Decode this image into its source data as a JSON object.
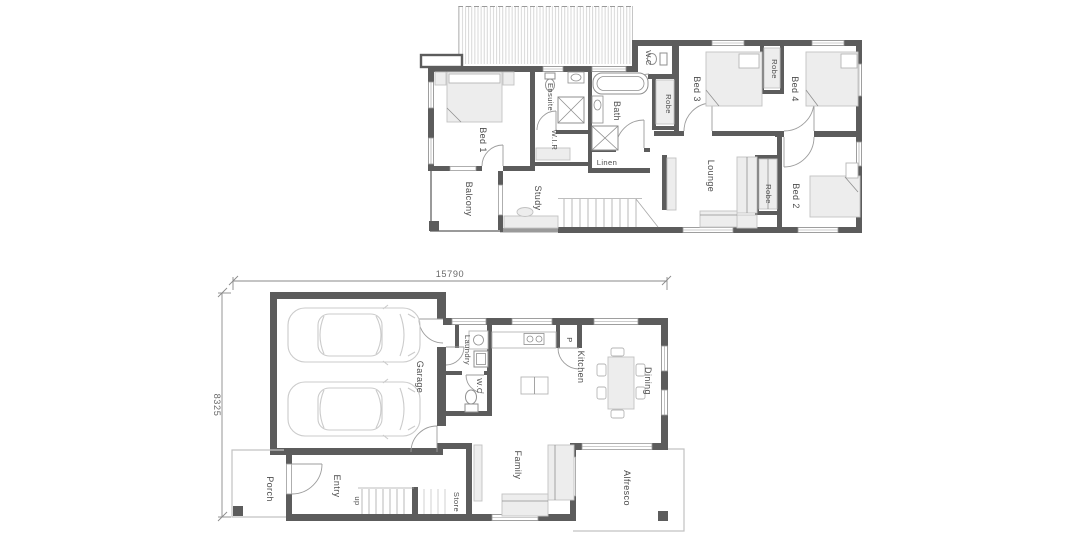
{
  "upper": {
    "bed1": "Bed 1",
    "balcony": "Balcony",
    "ensuite": "Ensuite",
    "wir": "W.I.R",
    "study": "Study",
    "bath": "Bath",
    "linen": "Linen",
    "wc": "W.C",
    "robe_bed3": "Robe",
    "bed3": "Bed 3",
    "robe_bed34": "Robe",
    "bed4": "Bed 4",
    "lounge": "Lounge",
    "robe_bed2": "Robe",
    "bed2": "Bed 2"
  },
  "ground": {
    "porch": "Porch",
    "entry": "Entry",
    "garage": "Garage",
    "laundry": "Laundry",
    "wc": "W.C",
    "kitchen": "Kitchen",
    "pantry": "P",
    "dining": "Dining",
    "family": "Family",
    "store": "Store",
    "alfresco": "Alfresco",
    "stairs": "up"
  },
  "dimensions": {
    "overall_width": "15790",
    "overall_depth": "8325"
  },
  "colors": {
    "wall": "#5c5c5c",
    "wall_light": "#9a9a9a",
    "furniture_fill": "#ededed",
    "furniture_stroke": "#c2c2c2",
    "car_outline": "#cbcbcb",
    "dimension": "#6a6a6a",
    "label_text": "#4c4c4c",
    "background": "#ffffff"
  }
}
